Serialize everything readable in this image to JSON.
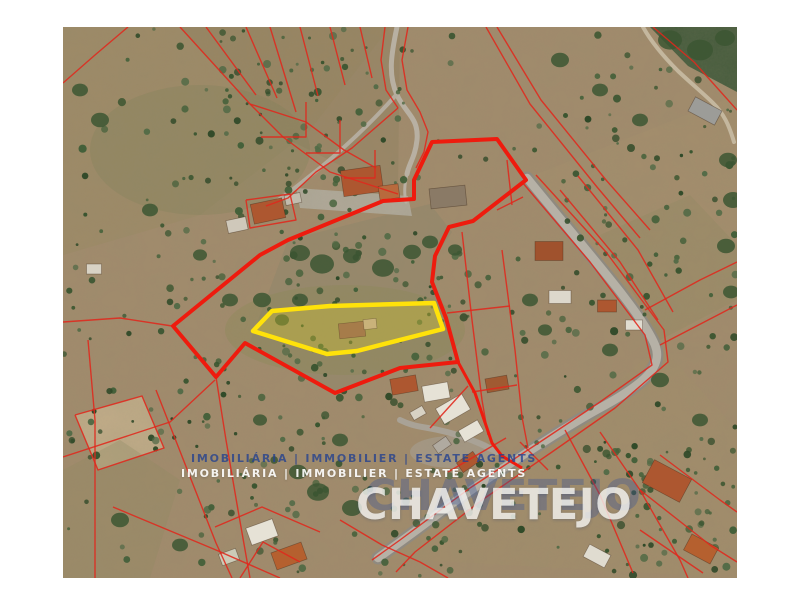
{
  "watermark": {
    "tagline": "IMOBILIÁRIA | IMMOBILIER | ESTATE AGENTS",
    "brand": "CHAVETEJO",
    "tagline_shadow_color": "#24418f",
    "tagline_color": "#ffffff",
    "brand_shadow_color": "#31509c",
    "brand_color": "#f5f5f3"
  },
  "map": {
    "type": "aerial-satellite-with-cadastral-overlay",
    "colors": {
      "main_boundary": "#ee1b0e",
      "cadastral_line": "#e0281c",
      "highlight_outline": "#ffe20a",
      "highlight_fill": "rgba(225,210,40,0.30)"
    },
    "main_boundary": [
      [
        432,
        142
      ],
      [
        497,
        139
      ],
      [
        526,
        180
      ],
      [
        473,
        221
      ],
      [
        449,
        227
      ],
      [
        435,
        256
      ],
      [
        432,
        282
      ],
      [
        446,
        318
      ],
      [
        452,
        340
      ],
      [
        458,
        362
      ],
      [
        400,
        368
      ],
      [
        335,
        393
      ],
      [
        245,
        343
      ],
      [
        216,
        377
      ],
      [
        173,
        326
      ],
      [
        260,
        255
      ],
      [
        288,
        240
      ],
      [
        383,
        201
      ],
      [
        414,
        199
      ],
      [
        414,
        180
      ]
    ],
    "boundary_branch": [
      [
        458,
        362
      ],
      [
        475,
        393
      ],
      [
        492,
        443
      ],
      [
        502,
        456
      ],
      [
        522,
        468
      ]
    ],
    "highlight_parcel": [
      [
        253,
        331
      ],
      [
        272,
        311
      ],
      [
        330,
        306
      ],
      [
        434,
        303
      ],
      [
        443,
        329
      ],
      [
        357,
        351
      ],
      [
        327,
        354
      ]
    ],
    "parcel_buildings": [
      [
        352,
        330,
        26,
        15,
        -6,
        "#a67c4a"
      ],
      [
        370,
        324,
        13,
        10,
        -6,
        "#c9b27a"
      ]
    ],
    "houses": [
      [
        362,
        181,
        40,
        26,
        -8,
        "#ad5730"
      ],
      [
        389,
        192,
        20,
        14,
        -8,
        "#b86a3d"
      ],
      [
        448,
        197,
        36,
        20,
        -6,
        "#8a7a66"
      ],
      [
        268,
        211,
        32,
        20,
        -12,
        "#ad5730"
      ],
      [
        237,
        225,
        20,
        13,
        -12,
        "#cfc8ba"
      ],
      [
        293,
        199,
        16,
        10,
        -12,
        "#c2bcae"
      ],
      [
        705,
        111,
        30,
        16,
        28,
        "#9c9c98"
      ],
      [
        549,
        251,
        28,
        19,
        0,
        "#a0522d"
      ],
      [
        560,
        297,
        22,
        13,
        0,
        "#ddd8cc"
      ],
      [
        607,
        306,
        19,
        12,
        0,
        "#ad5730"
      ],
      [
        634,
        325,
        17,
        10,
        0,
        "#e0dcd0"
      ],
      [
        404,
        385,
        26,
        16,
        -10,
        "#ad5730"
      ],
      [
        436,
        392,
        26,
        16,
        -10,
        "#e6e2d6"
      ],
      [
        453,
        409,
        30,
        18,
        -30,
        "#e6e2d6"
      ],
      [
        471,
        431,
        22,
        13,
        -30,
        "#e6e2d6"
      ],
      [
        497,
        384,
        22,
        14,
        -10,
        "#a05a32"
      ],
      [
        418,
        413,
        14,
        9,
        -30,
        "#d8d2c4"
      ],
      [
        468,
        462,
        20,
        12,
        -35,
        "#ad5730"
      ],
      [
        442,
        445,
        16,
        10,
        -35,
        "#b0aaa0"
      ],
      [
        667,
        481,
        42,
        26,
        28,
        "#ad5730"
      ],
      [
        701,
        549,
        30,
        18,
        28,
        "#b5602f"
      ],
      [
        597,
        556,
        24,
        14,
        28,
        "#e0dcd0"
      ],
      [
        262,
        532,
        28,
        18,
        -20,
        "#e6e2d6"
      ],
      [
        289,
        556,
        32,
        18,
        -20,
        "#b5602f"
      ],
      [
        229,
        557,
        18,
        12,
        -20,
        "#cccbb7"
      ],
      [
        94,
        269,
        15,
        10,
        0,
        "#d8d2c4"
      ]
    ],
    "cadastral_lines": [
      [
        [
          63,
          83
        ],
        [
          95,
          55
        ],
        [
          128,
          27
        ]
      ],
      [
        [
          180,
          27
        ],
        [
          250,
          104
        ],
        [
          283,
          137
        ],
        [
          330,
          172
        ],
        [
          398,
          194
        ]
      ],
      [
        [
          206,
          27
        ],
        [
          256,
          95
        ]
      ],
      [
        [
          246,
          27
        ],
        [
          277,
          98
        ]
      ],
      [
        [
          270,
          27
        ],
        [
          296,
          112
        ]
      ],
      [
        [
          300,
          27
        ],
        [
          318,
          96
        ]
      ],
      [
        [
          330,
          27
        ],
        [
          345,
          85
        ]
      ],
      [
        [
          360,
          27
        ],
        [
          372,
          78
        ]
      ],
      [
        [
          250,
          104
        ],
        [
          306,
          122
        ],
        [
          344,
          150
        ],
        [
          376,
          168
        ]
      ],
      [
        [
          261,
          137
        ],
        [
          306,
          137
        ],
        [
          306,
          102
        ]
      ],
      [
        [
          306,
          153
        ],
        [
          340,
          153
        ],
        [
          340,
          120
        ]
      ],
      [
        [
          344,
          178
        ],
        [
          375,
          178
        ],
        [
          375,
          150
        ]
      ],
      [
        [
          385,
          27
        ],
        [
          381,
          60
        ],
        [
          386,
          90
        ],
        [
          398,
          108
        ]
      ],
      [
        [
          408,
          27
        ],
        [
          402,
          60
        ],
        [
          407,
          90
        ],
        [
          420,
          112
        ],
        [
          428,
          132
        ],
        [
          424,
          152
        ],
        [
          416,
          168
        ]
      ],
      [
        [
          398,
          108
        ],
        [
          352,
          148
        ],
        [
          316,
          172
        ],
        [
          288,
          198
        ],
        [
          266,
          206
        ]
      ],
      [
        [
          486,
          27
        ],
        [
          530,
          104
        ],
        [
          597,
          187
        ],
        [
          640,
          238
        ]
      ],
      [
        [
          497,
          27
        ],
        [
          541,
          100
        ],
        [
          606,
          180
        ],
        [
          650,
          230
        ]
      ],
      [
        [
          653,
          27
        ],
        [
          694,
          62
        ],
        [
          737,
          110
        ]
      ],
      [
        [
          522,
          182
        ],
        [
          590,
          262
        ],
        [
          645,
          335
        ],
        [
          652,
          365
        ],
        [
          600,
          402
        ],
        [
          540,
          442
        ],
        [
          470,
          488
        ],
        [
          400,
          540
        ],
        [
          372,
          560
        ]
      ],
      [
        [
          536,
          175
        ],
        [
          606,
          252
        ],
        [
          664,
          330
        ],
        [
          668,
          362
        ],
        [
          615,
          408
        ],
        [
          552,
          452
        ],
        [
          482,
          500
        ],
        [
          415,
          552
        ],
        [
          396,
          572
        ]
      ],
      [
        [
          560,
          190
        ],
        [
          620,
          262
        ],
        [
          658,
          320
        ]
      ],
      [
        [
          578,
          176
        ],
        [
          638,
          250
        ],
        [
          673,
          312
        ]
      ],
      [
        [
          645,
          310
        ],
        [
          700,
          280
        ],
        [
          737,
          262
        ]
      ],
      [
        [
          660,
          345
        ],
        [
          712,
          318
        ],
        [
          737,
          305
        ]
      ],
      [
        [
          565,
          430
        ],
        [
          600,
          495
        ],
        [
          633,
          573
        ]
      ],
      [
        [
          600,
          432
        ],
        [
          640,
          490
        ],
        [
          680,
          560
        ],
        [
          688,
          578
        ]
      ],
      [
        [
          640,
          530
        ],
        [
          703,
          573
        ]
      ],
      [
        [
          640,
          490
        ],
        [
          710,
          545
        ],
        [
          737,
          562
        ]
      ],
      [
        [
          660,
          455
        ],
        [
          720,
          500
        ],
        [
          737,
          512
        ]
      ],
      [
        [
          88,
          340
        ],
        [
          95,
          420
        ],
        [
          95,
          578
        ]
      ],
      [
        [
          63,
          457
        ],
        [
          170,
          422
        ],
        [
          215,
          380
        ]
      ],
      [
        [
          156,
          390
        ],
        [
          216,
          543
        ],
        [
          232,
          578
        ]
      ],
      [
        [
          113,
          507
        ],
        [
          216,
          550
        ],
        [
          280,
          578
        ]
      ],
      [
        [
          216,
          377
        ],
        [
          226,
          440
        ],
        [
          238,
          510
        ],
        [
          250,
          578
        ]
      ],
      [
        [
          462,
          232
        ],
        [
          472,
          320
        ],
        [
          482,
          400
        ],
        [
          488,
          435
        ]
      ],
      [
        [
          502,
          250
        ],
        [
          515,
          350
        ],
        [
          522,
          417
        ],
        [
          528,
          448
        ]
      ],
      [
        [
          447,
          313
        ],
        [
          510,
          306
        ]
      ],
      [
        [
          472,
          392
        ],
        [
          517,
          385
        ]
      ],
      [
        [
          497,
          210
        ],
        [
          523,
          197
        ]
      ],
      [
        [
          507,
          160
        ],
        [
          512,
          205
        ]
      ],
      [
        [
          430,
          428
        ],
        [
          468,
          386
        ]
      ],
      [
        [
          448,
          472
        ],
        [
          506,
          438
        ]
      ],
      [
        [
          520,
          442
        ],
        [
          548,
          470
        ]
      ],
      [
        [
          246,
          200
        ],
        [
          290,
          194
        ],
        [
          296,
          220
        ],
        [
          250,
          228
        ],
        [
          246,
          200
        ]
      ],
      [
        [
          215,
          527
        ],
        [
          262,
          507
        ],
        [
          320,
          532
        ]
      ],
      [
        [
          240,
          578
        ],
        [
          263,
          542
        ],
        [
          300,
          562
        ]
      ],
      [
        [
          340,
          520
        ],
        [
          382,
          545
        ],
        [
          420,
          562
        ],
        [
          448,
          578
        ]
      ],
      [
        [
          63,
          322
        ],
        [
          120,
          318
        ],
        [
          172,
          326
        ]
      ],
      [
        [
          75,
          415
        ],
        [
          142,
          396
        ],
        [
          164,
          448
        ],
        [
          98,
          470
        ],
        [
          75,
          415
        ]
      ]
    ]
  }
}
